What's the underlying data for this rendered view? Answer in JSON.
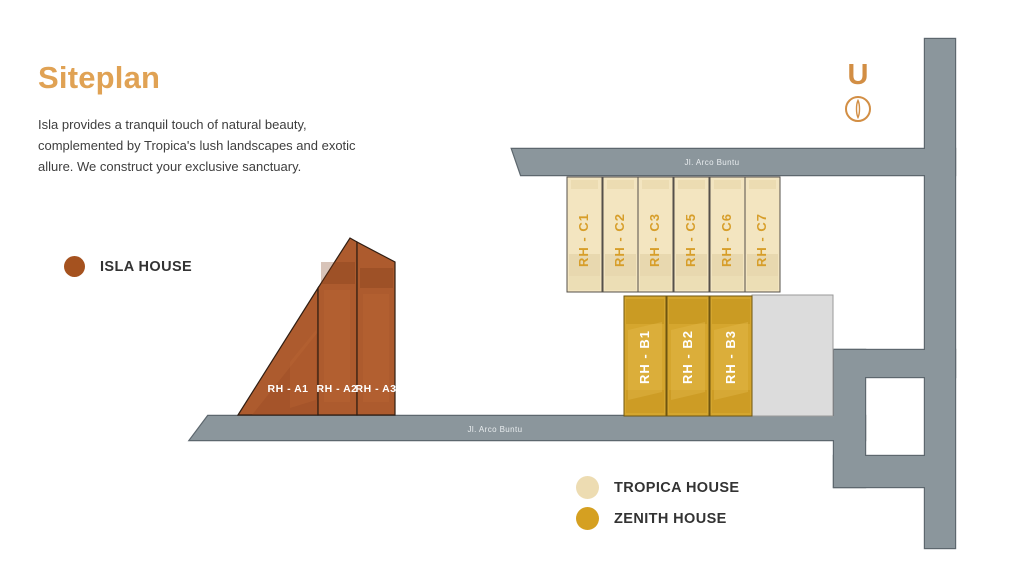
{
  "header": {
    "title": "Siteplan",
    "description_lines": [
      "Isla provides a tranquil touch of natural beauty,",
      "complemented by Tropica's lush landscapes and exotic",
      "allure. We construct your exclusive sanctuary."
    ]
  },
  "compass": {
    "letter": "U"
  },
  "legend": {
    "isla": {
      "label": "ISLA HOUSE",
      "color": "#A5521F"
    },
    "tropica": {
      "label": "TROPICA HOUSE",
      "color": "#EDDCB2"
    },
    "zenith": {
      "label": "ZENITH HOUSE",
      "color": "#D5A021"
    }
  },
  "roads": {
    "top_label": "Jl. Arco Buntu",
    "bottom_label": "Jl. Arco Buntu",
    "color": "#8B969C"
  },
  "houses": {
    "isla": {
      "fill": "#AD5B2E",
      "label_color": "#FFFFFF",
      "units": [
        "RH - A1",
        "RH - A2",
        "RH - A3"
      ]
    },
    "tropica": {
      "fill": "#F3E5C0",
      "label_color": "#D79E2A",
      "units": [
        "RH - C1",
        "RH - C2",
        "RH - C3",
        "RH - C5",
        "RH - C6",
        "RH - C7"
      ]
    },
    "zenith": {
      "fill": "#D5A62E",
      "label_color": "#FFFFFF",
      "units": [
        "RH - B1",
        "RH - B2",
        "RH - B3"
      ]
    }
  }
}
